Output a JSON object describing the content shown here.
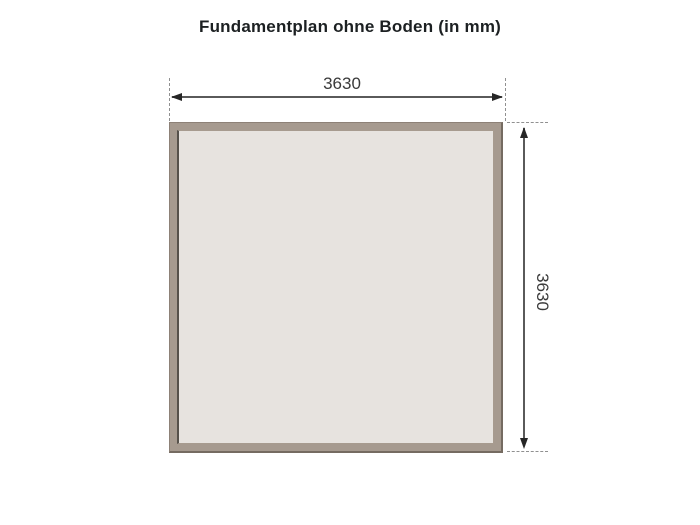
{
  "page": {
    "title": "Fundamentplan ohne Boden (in mm)"
  },
  "diagram": {
    "type": "foundation-plan",
    "unit": "mm",
    "width_dimension_label": "3630",
    "height_dimension_label": "3630",
    "colors": {
      "background": "#ffffff",
      "title_text": "#1c2022",
      "frame_fill": "#a69a8f",
      "frame_edge": "#8d8177",
      "inner_fill": "#e7e3df",
      "inner_edge": "#56514b",
      "dimension_line": "#5a5a5a",
      "arrowhead": "#262626",
      "extension_line": "#909090",
      "label_text": "#3a3a3a"
    }
  }
}
